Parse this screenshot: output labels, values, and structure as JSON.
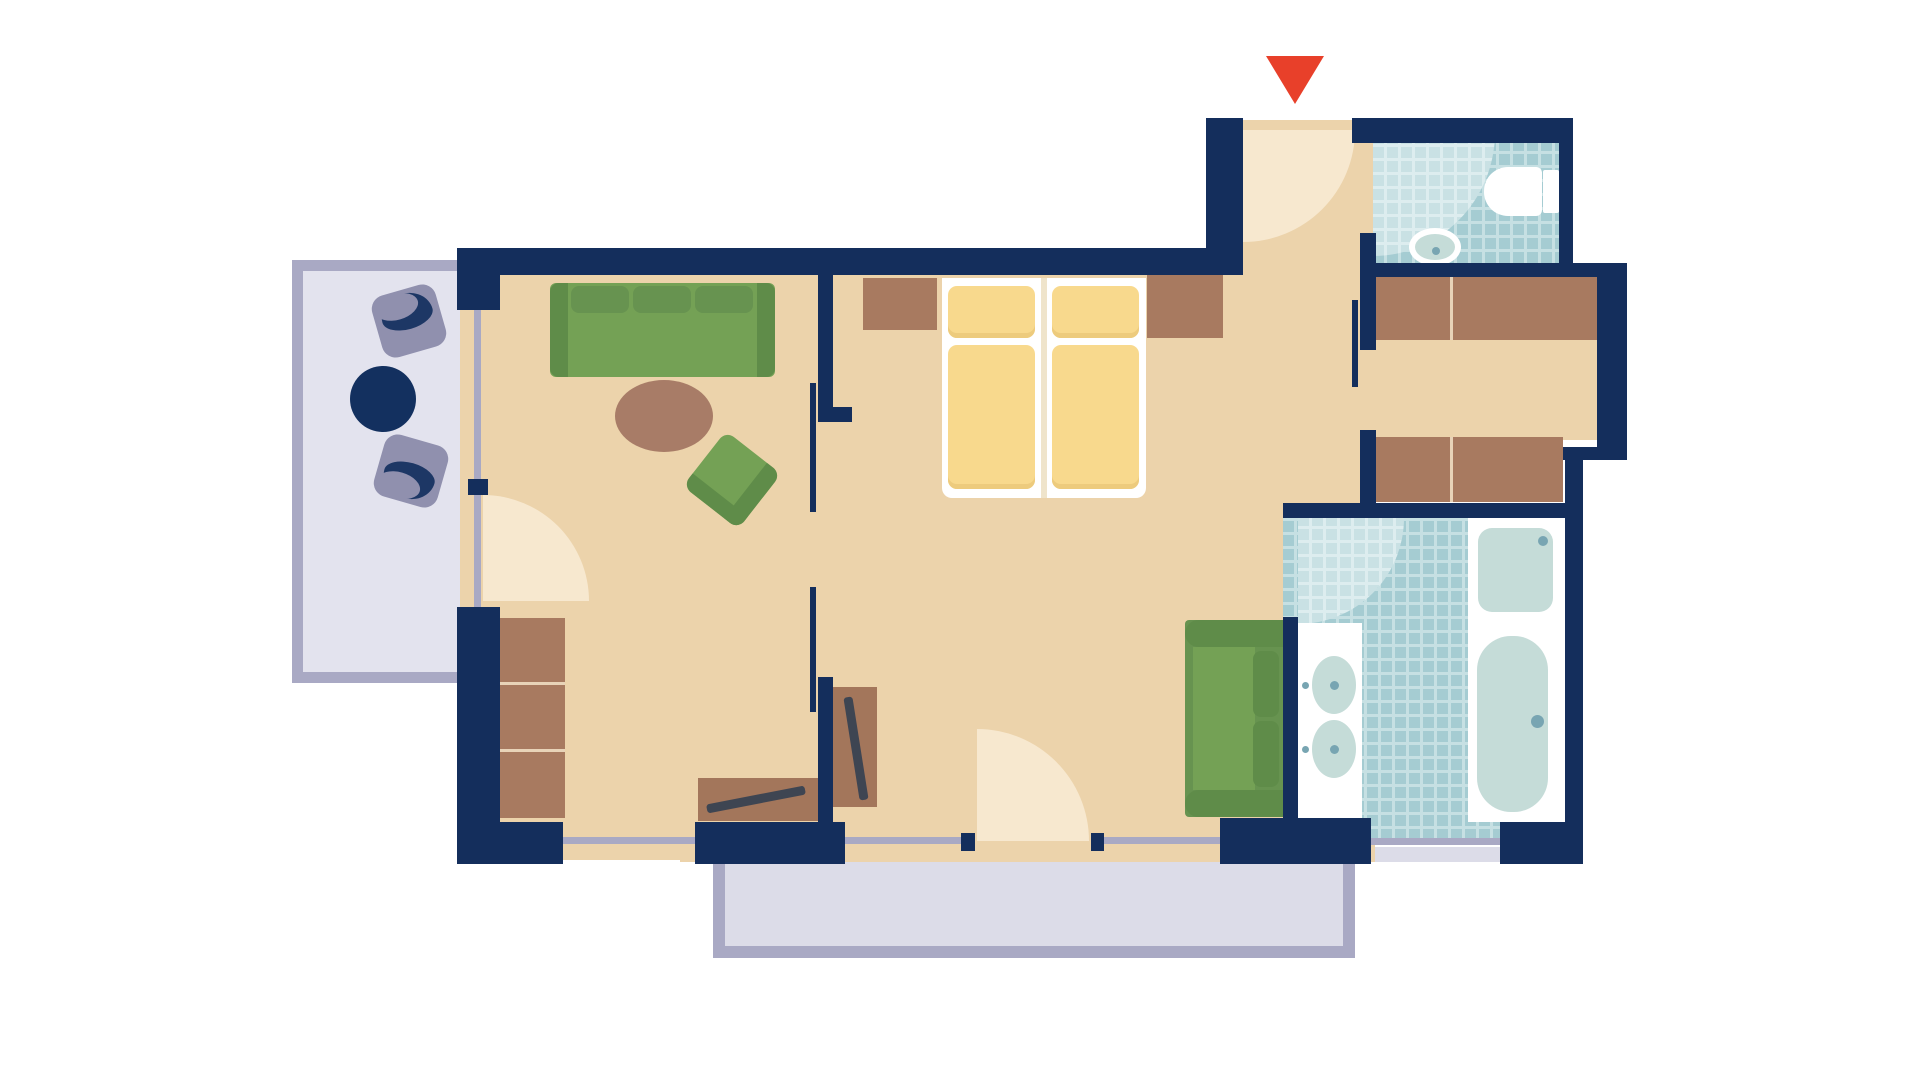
{
  "title": "hotel-suite-floor-plan",
  "colors": {
    "wall": "#142e5c",
    "floor": "#ecd3ab",
    "door_arc": "#f7e8cf",
    "window_line": "#a9a9c4",
    "balcony_border": "#a9a9c4",
    "balcony_fill": "#e3e3ee",
    "terrace_fill": "#dcdce8",
    "tile": "#a5ccd2",
    "tile_line": "#c6e0e3",
    "tile_light": "#c9e1e4",
    "tile_light_line": "#ddedef",
    "fixture_white": "#ffffff",
    "fixture_fill": "#c5dcd8",
    "fixture_dot": "#78a5b2",
    "wood": "#a87a60",
    "wood_divider": "#e8d3b8",
    "desk_wood": "#a3765b",
    "bar_dark": "#3e4552",
    "sofa_green": "#74a155",
    "sofa_green_dark": "#5f8c49",
    "sofa_green_mid": "#679350",
    "bed_yellow": "#f8d98d",
    "bed_yellow_dark": "#edcb7d",
    "bed_frame": "#ffffff",
    "bed_gap": "#efe4cb",
    "table_brown": "#a87c67",
    "chair_grey": "#9090ae",
    "chair_cushion": "#1d3765",
    "navy_table": "#13305f",
    "arrow_red": "#e8402a"
  },
  "elements": {
    "entrance": [
      "entrance-arrow",
      "entrance-door-arc"
    ],
    "rooms": [
      "living-room",
      "bedroom",
      "entrance-hall",
      "dressing-corridor",
      "wc",
      "bathroom",
      "balcony",
      "terrace"
    ],
    "living_room": [
      "sofa-three-seat",
      "coffee-table-oval",
      "armchair",
      "shelf-unit",
      "desk-with-bench",
      "luggage-rack",
      "balcony-door-arc"
    ],
    "bedroom": [
      "twin-bed-left",
      "twin-bed-right",
      "nightstand-left",
      "nightstand-right",
      "loveseat",
      "terrace-door-arc"
    ],
    "dressing_corridor": [
      "wardrobe-upper",
      "wardrobe-lower",
      "sliding-door-line"
    ],
    "wc": [
      "toilet",
      "wc-sink",
      "wc-door-arc"
    ],
    "bathroom": [
      "double-vanity",
      "vanity-sink-1",
      "vanity-sink-2",
      "shower",
      "bathtub",
      "bathroom-door-arc",
      "bathroom-window"
    ],
    "balcony": [
      "balcony-armchair-1",
      "balcony-armchair-2",
      "balcony-round-table"
    ],
    "windows": [
      "living-window-left",
      "living-window-bottom",
      "bedroom-window-left",
      "bedroom-window-right",
      "bathroom-window"
    ]
  }
}
